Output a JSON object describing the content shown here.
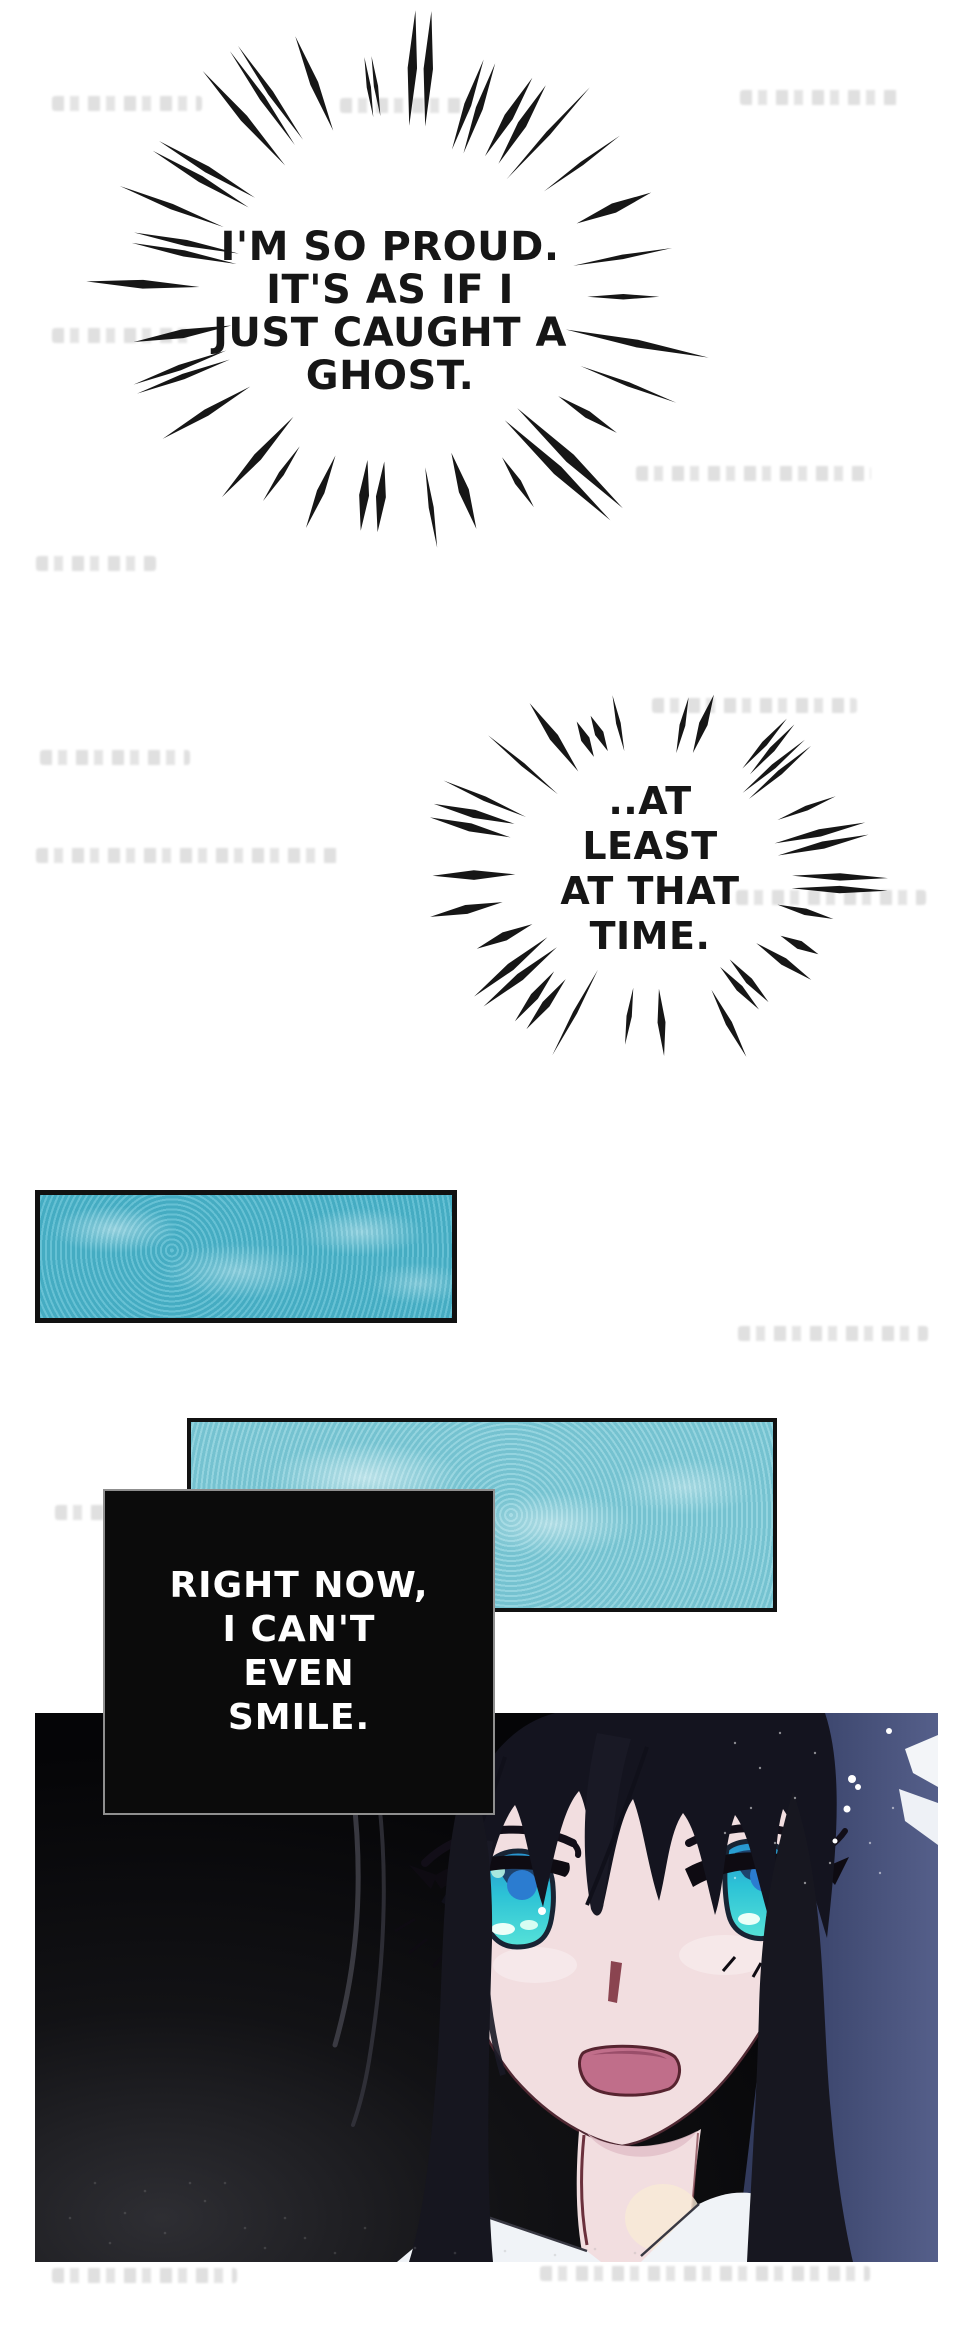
{
  "bubbles": [
    {
      "id": "burst-1",
      "lines": [
        "I'M SO PROUD.",
        "IT'S AS IF I",
        "JUST CAUGHT A",
        "GHOST."
      ]
    },
    {
      "id": "burst-2",
      "lines": [
        "..AT",
        "LEAST",
        "AT THAT",
        "TIME."
      ]
    }
  ],
  "caption": {
    "lines": [
      "RIGHT NOW,",
      "I CAN'T",
      "EVEN",
      "SMILE."
    ]
  },
  "colors": {
    "ink": "#161616",
    "teal1": "#4db7cd",
    "teal2": "#7fccd9",
    "cap-bg": "#0b0b0b",
    "cap-border": "#8f8f8f",
    "cap-fg": "#ffffff",
    "skin": "#f2dee0",
    "hair": "#14141f",
    "hair-blue": "#41507a",
    "eye": "#2cc2d6",
    "pupil": "#2b7cd0",
    "mouth": "#c06e8a",
    "outline": "#4f2832",
    "shirt": "#f0f3f7"
  }
}
